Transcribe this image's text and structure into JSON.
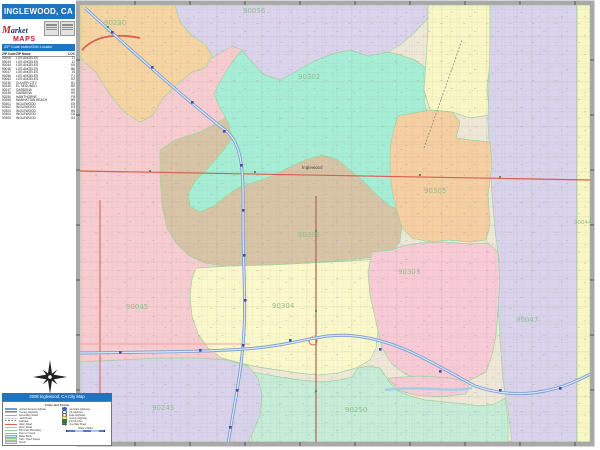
{
  "header": {
    "title": "INGLEWOOD, CA"
  },
  "logo": {
    "brand_script": "Market",
    "brand_bold": "MAPS"
  },
  "index_panel": {
    "header": "ZIP Code Index/Grid Locator",
    "columns": [
      "ZIP Code",
      "ZIP Name",
      "LOC"
    ],
    "rows": [
      [
        "90008",
        "LOS ANGELES",
        "J1"
      ],
      [
        "90043",
        "LOS ANGELES",
        "J2"
      ],
      [
        "90044",
        "LOS ANGELES",
        "K5"
      ],
      [
        "90045",
        "LOS ANGELES",
        "B6"
      ],
      [
        "90047",
        "LOS ANGELES",
        "J5"
      ],
      [
        "90056",
        "LOS ANGELES",
        "F1"
      ],
      [
        "90062",
        "LOS ANGELES",
        "K2"
      ],
      [
        "90230",
        "CULVER CITY",
        "B1"
      ],
      [
        "90245",
        "EL SEGUNDO",
        "B9"
      ],
      [
        "90247",
        "GARDENA",
        "K9"
      ],
      [
        "90249",
        "GARDENA",
        "H9"
      ],
      [
        "90250",
        "HAWTHORNE",
        "F8"
      ],
      [
        "90266",
        "MANHATTAN BEACH",
        "B9"
      ],
      [
        "90301",
        "INGLEWOOD",
        "E5"
      ],
      [
        "90302",
        "INGLEWOOD",
        "E3"
      ],
      [
        "90303",
        "INGLEWOOD",
        "H6"
      ],
      [
        "90304",
        "INGLEWOOD",
        "C6"
      ],
      [
        "90305",
        "INGLEWOOD",
        "G4"
      ]
    ]
  },
  "footer": {
    "bar_title": "2008 Inglewood, CA City Map",
    "legend_title": "Cities and Towns",
    "legend_left": [
      {
        "label": "Limited Access Highway",
        "swatch": "sw-fwy"
      },
      {
        "label": "Primary Highway",
        "swatch": "sw-hwy"
      },
      {
        "label": "Secondary Road",
        "swatch": "sw-road2"
      },
      {
        "label": "Local Road",
        "swatch": "sw-road3"
      },
      {
        "label": "Railroad",
        "swatch": "sw-rail"
      },
      {
        "label": "Major Road",
        "swatch": "sw-red"
      },
      {
        "label": "Minor Road",
        "swatch": "sw-pink"
      },
      {
        "label": "ZIP Code Boundary",
        "swatch": "sw-zip"
      },
      {
        "label": "River or Creek",
        "swatch": "sw-river"
      },
      {
        "label": "Water Body",
        "swatch": "sw-water"
      },
      {
        "label": "Park / Open Space",
        "swatch": "sw-park"
      },
      {
        "label": "Airport",
        "swatch": "sw-airport"
      }
    ],
    "legend_right": [
      {
        "label": "Interstate Highway",
        "swatch": "sh-int"
      },
      {
        "label": "US Highway",
        "swatch": "sh-us"
      },
      {
        "label": "State Highway",
        "swatch": "sh-state"
      },
      {
        "label": "County Highway",
        "swatch": "sh-cty"
      },
      {
        "label": "Exit Number",
        "swatch": "sh-exit"
      },
      {
        "label": "One-Way Road",
        "swatch": "sh-oneway"
      }
    ],
    "scale_title": "Scale in Miles"
  },
  "map": {
    "zip_label_color": "#8fbf8f",
    "boundary_color": "#9ed69e",
    "freeway_color": "#7b9cd0",
    "road_color": "#d95f4e",
    "city_label": {
      "text": "Inglewood",
      "x": 302,
      "y": 169
    },
    "regions": [
      {
        "id": "r90045",
        "zip": "90045",
        "color": "#f7cdd2",
        "label_x": 126,
        "label_y": 309,
        "label_size": 7
      },
      {
        "id": "r90301",
        "zip": "90301",
        "color": "#d8c4a6",
        "label_x": 298,
        "label_y": 237,
        "label_size": 7
      },
      {
        "id": "r90302",
        "zip": "90302",
        "color": "#a6eed6",
        "label_x": 298,
        "label_y": 79,
        "label_size": 7
      },
      {
        "id": "r90056",
        "zip": "90056",
        "color": "#dcd3ed",
        "label_x": 243,
        "label_y": 13,
        "label_size": 7
      },
      {
        "id": "r90230",
        "zip": "90230",
        "color": "#f6d5a2",
        "label_x": 104,
        "label_y": 25,
        "label_size": 7
      },
      {
        "id": "r90304",
        "zip": "90304",
        "color": "#fbf9cb",
        "label_x": 272,
        "label_y": 308,
        "label_size": 7
      },
      {
        "id": "r90043",
        "zip": null,
        "color": "#faf7c6"
      },
      {
        "id": "r90047",
        "zip": "90047",
        "color": "#d9d3ec",
        "label_x": 516,
        "label_y": 322,
        "label_size": 7
      },
      {
        "id": "r90044",
        "zip": "90044",
        "color": "#faf7c6",
        "label_x": 574,
        "label_y": 224,
        "label_size": 5.5
      },
      {
        "id": "r90305",
        "zip": "90305",
        "color": "#f6cfa2",
        "label_x": 424,
        "label_y": 193,
        "label_size": 7
      },
      {
        "id": "r90303",
        "zip": "90303",
        "color": "#f8cbd6",
        "label_x": 398,
        "label_y": 274,
        "label_size": 7
      },
      {
        "id": "r90250",
        "zip": "90250",
        "color": "#c5edd7",
        "label_x": 345,
        "label_y": 412,
        "label_size": 7
      },
      {
        "id": "r90245",
        "zip": "90245",
        "color": "#d9d3ec",
        "label_x": 152,
        "label_y": 410,
        "label_size": 7
      },
      {
        "id": "rwedge",
        "zip": null,
        "color": "#f8cbd6"
      }
    ]
  }
}
